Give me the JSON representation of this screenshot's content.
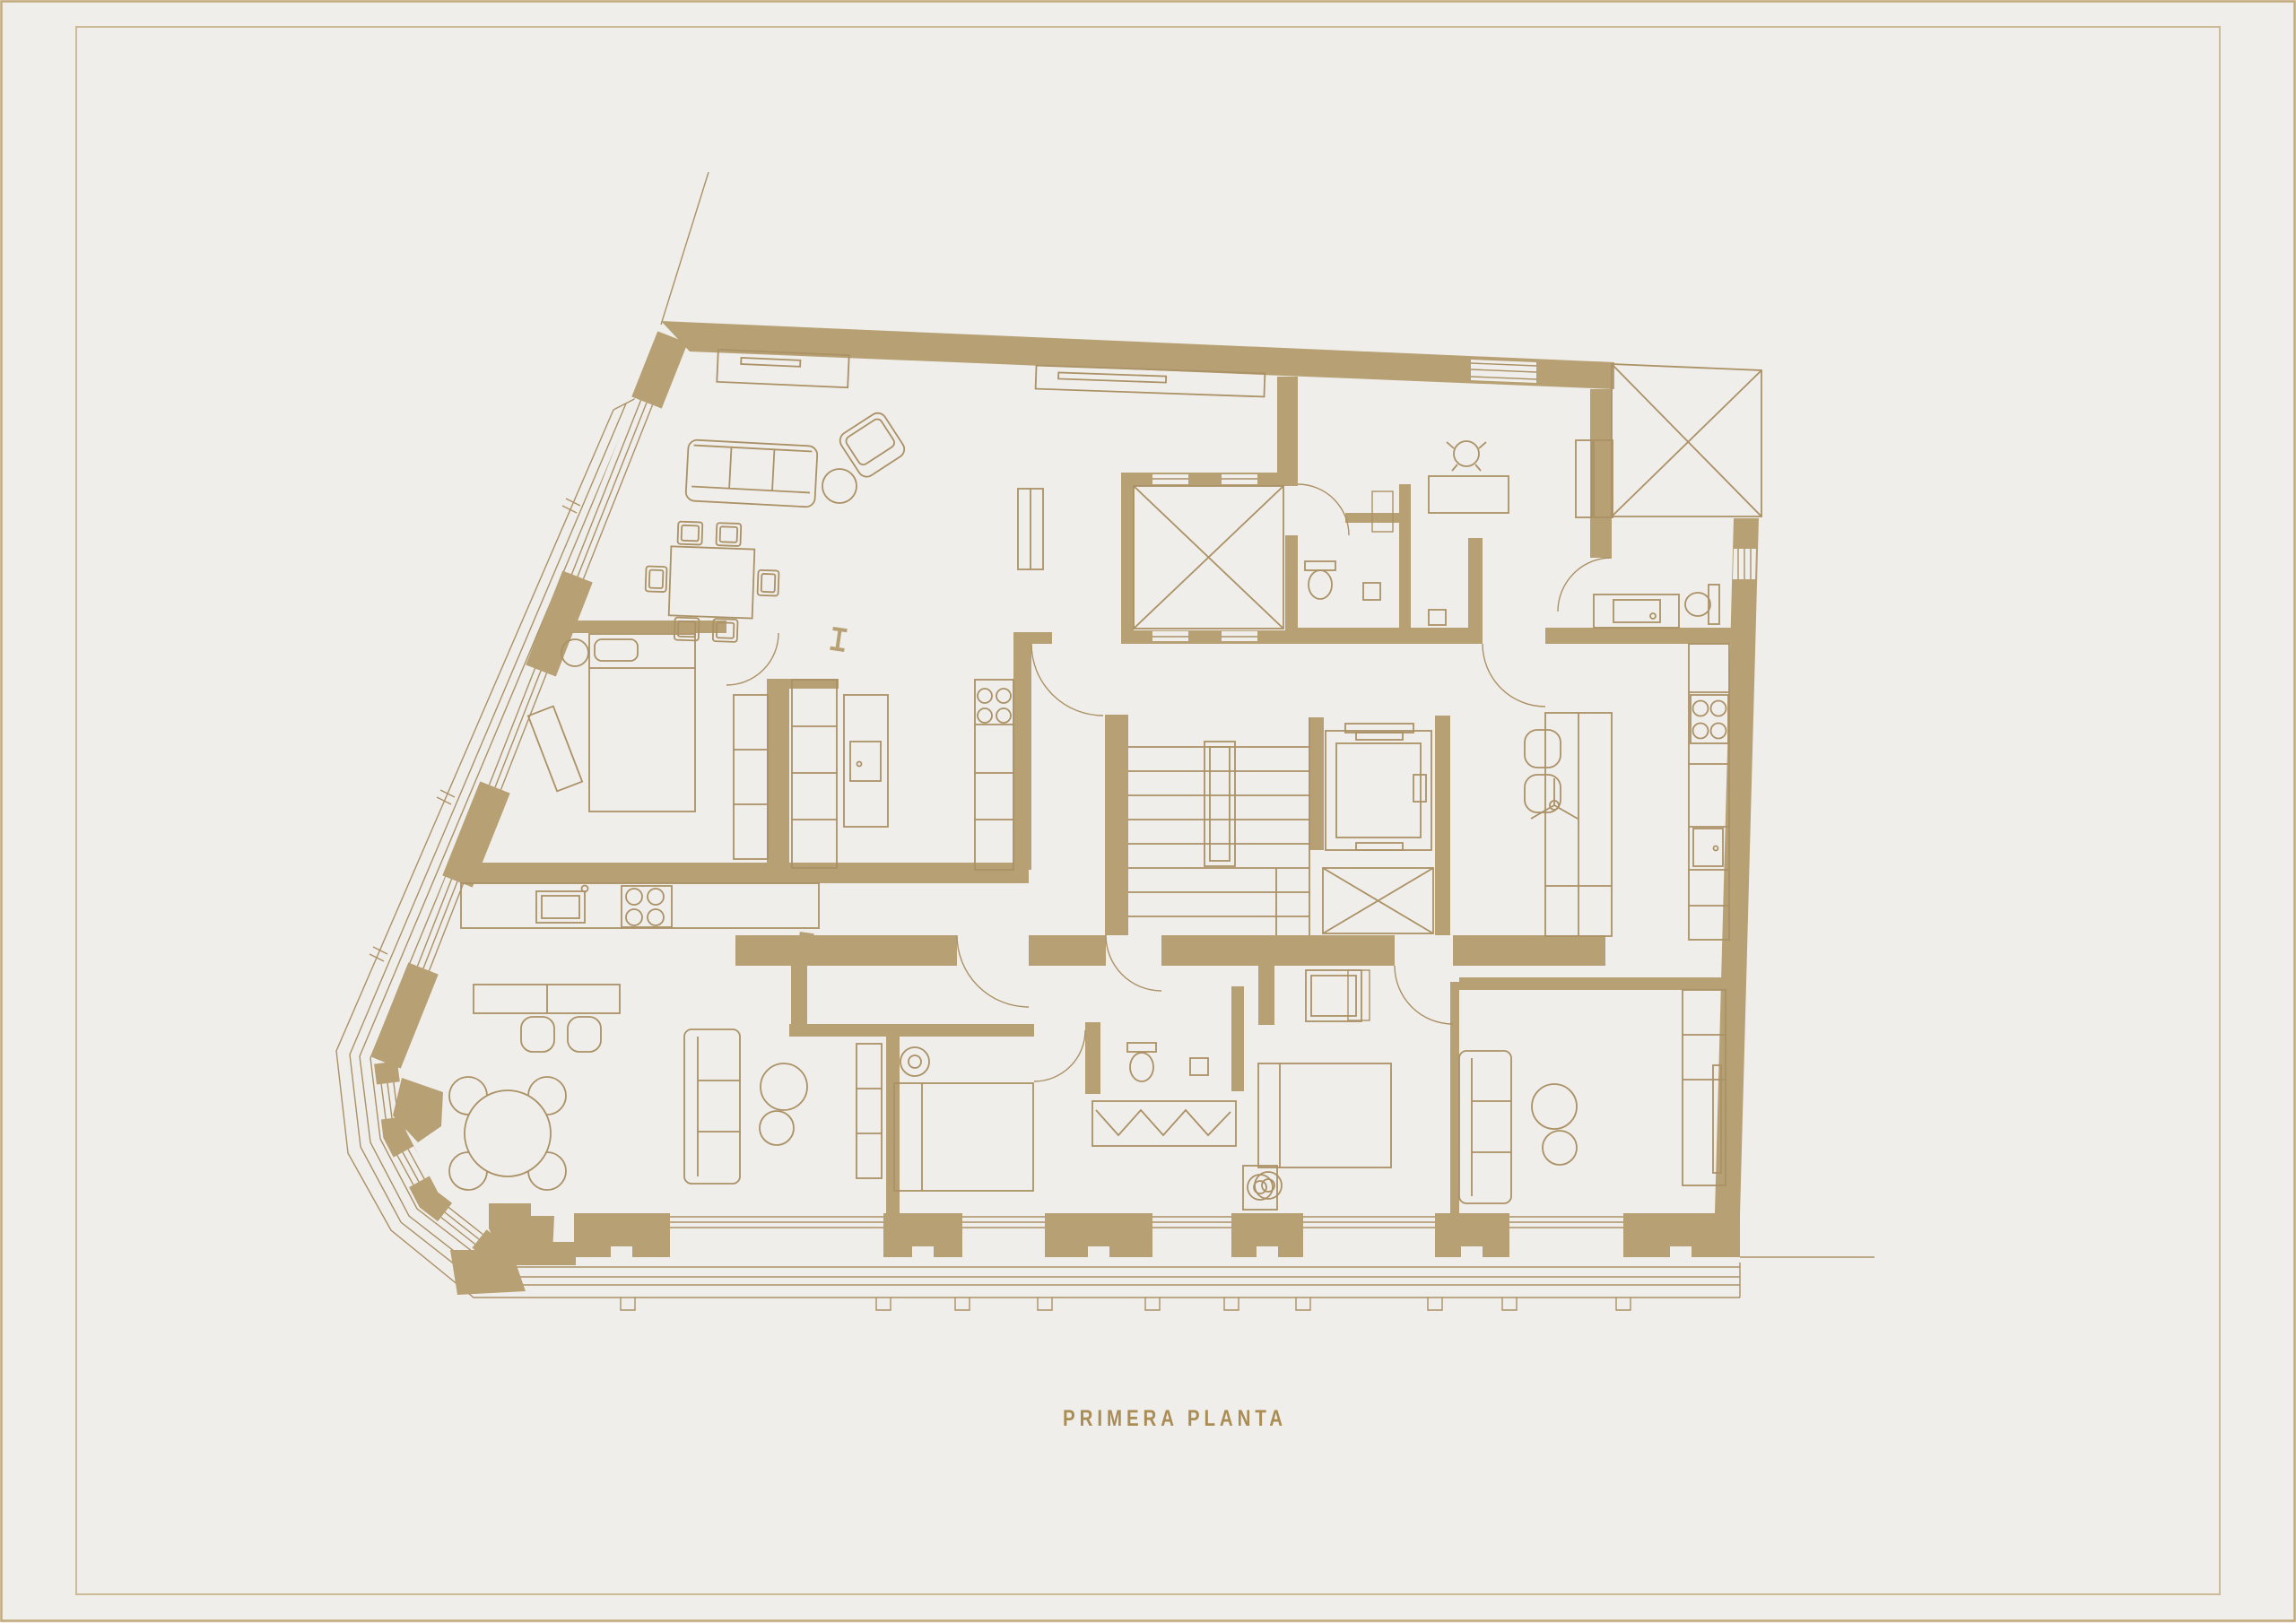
{
  "title": "PRIMERA PLANTA",
  "palette": {
    "background": "#f0eeea",
    "wall_fill": "#b7a074",
    "line_color": "#ab9166",
    "frame_outer": "#c2aa7c",
    "frame_inner": "#cbbb94",
    "title_color": "#aa8c55"
  },
  "drawing": {
    "type": "architectural-floor-plan",
    "floor_label": "PRIMERA PLANTA",
    "features": [
      "exterior-walls",
      "interior-walls",
      "windows",
      "balcony-left",
      "balcony-bottom",
      "staircase",
      "elevator",
      "light-wells",
      "door-swings",
      "kitchen-counter",
      "kitchen-island",
      "island-stools",
      "cooktops",
      "sinks",
      "beds",
      "nightstands",
      "wardrobes",
      "sofas",
      "armchair",
      "dining-table",
      "round-terrace-table",
      "side-tables",
      "toilets",
      "vanity",
      "desk",
      "desk-chair",
      "washing-machine",
      "hanging-rail-closet",
      "structural-columns",
      "section-markers",
      "ceiling-fan",
      "property-lines"
    ]
  }
}
